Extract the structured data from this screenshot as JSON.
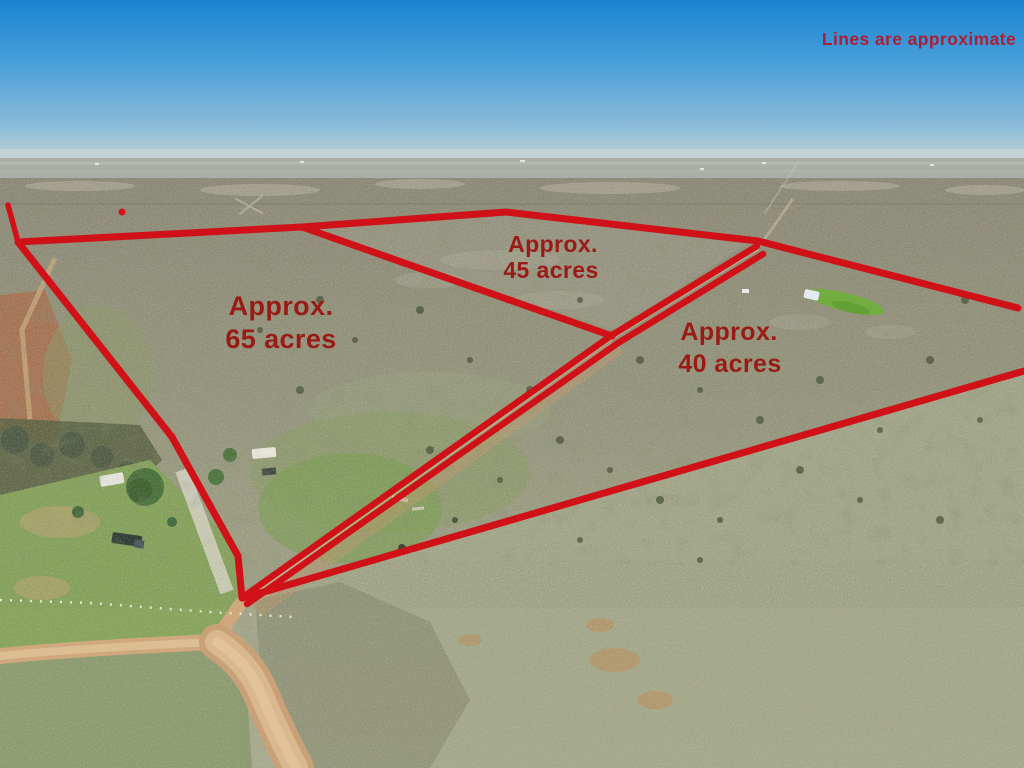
{
  "overlay": {
    "disclaimer": "Lines are approximate",
    "line_color": "#d01218",
    "label_color": "#9a1b16",
    "disclaimer_color": "#ad1e33",
    "parcels": [
      {
        "name": "parcel-65",
        "line1": "Approx.",
        "line2": "65 acres"
      },
      {
        "name": "parcel-45",
        "line1": "Approx.",
        "line2": "45 acres"
      },
      {
        "name": "parcel-40",
        "line1": "Approx.",
        "line2": "40 acres"
      }
    ]
  }
}
